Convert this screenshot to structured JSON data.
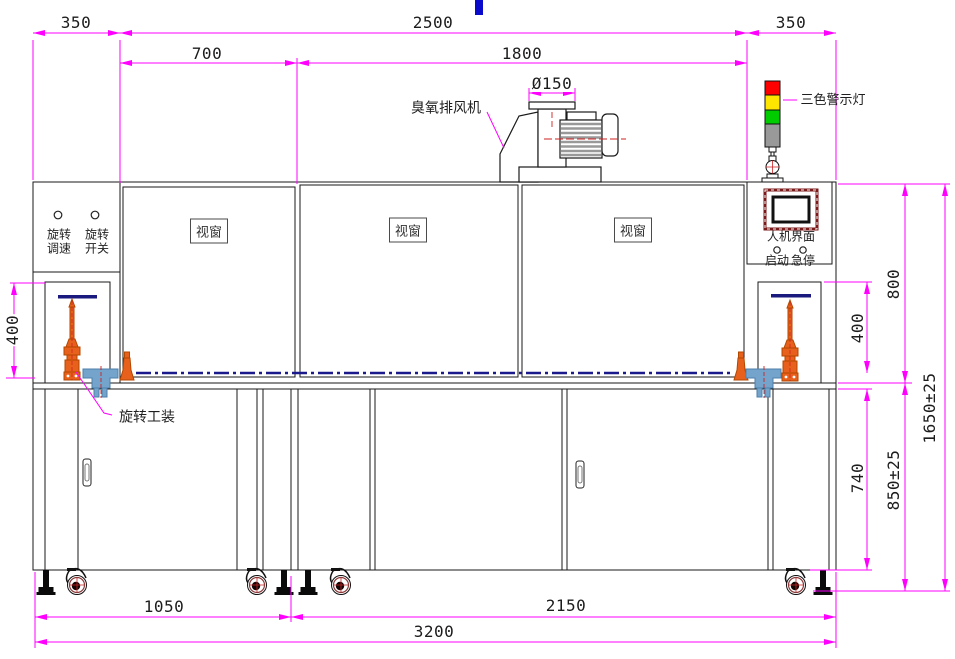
{
  "drawing": {
    "dims": {
      "d350_left": "350",
      "d2500": "2500",
      "d350_right": "350",
      "d700": "700",
      "d1800": "1800",
      "d150": "Ø150",
      "d400_left": "400",
      "d400_right": "400",
      "d800": "800",
      "d1650": "1650±25",
      "d740": "740",
      "d850": "850±25",
      "d1050": "1050",
      "d2150": "2150",
      "d3200": "3200"
    },
    "labels": {
      "ozone_fan": "臭氧排风机",
      "tricolor_light": "三色警示灯",
      "viewport": "视窗",
      "knob_speed_l1": "旋转",
      "knob_speed_l2": "调速",
      "knob_switch_l1": "旋转",
      "knob_switch_l2": "开关",
      "hmi": "人机界面",
      "start": "启动",
      "estop": "急停",
      "rotary_fixture": "旋转工装"
    },
    "colors": {
      "dimension_magenta": "#FF00FF",
      "centerline_navy": "#1A1A8C",
      "fixture_orange": "#E8611C",
      "bracket_blue": "#74A4CC",
      "light_red": "#FF0000",
      "light_yellow": "#FFE600",
      "light_green": "#00CC00",
      "light_gray": "#999999",
      "hmi_frame_maroon": "#7B1A1A",
      "caster_maroon": "#8B3A3A",
      "top_marker_blue": "#0A0ACD",
      "red_centerline": "#CC2222"
    }
  }
}
